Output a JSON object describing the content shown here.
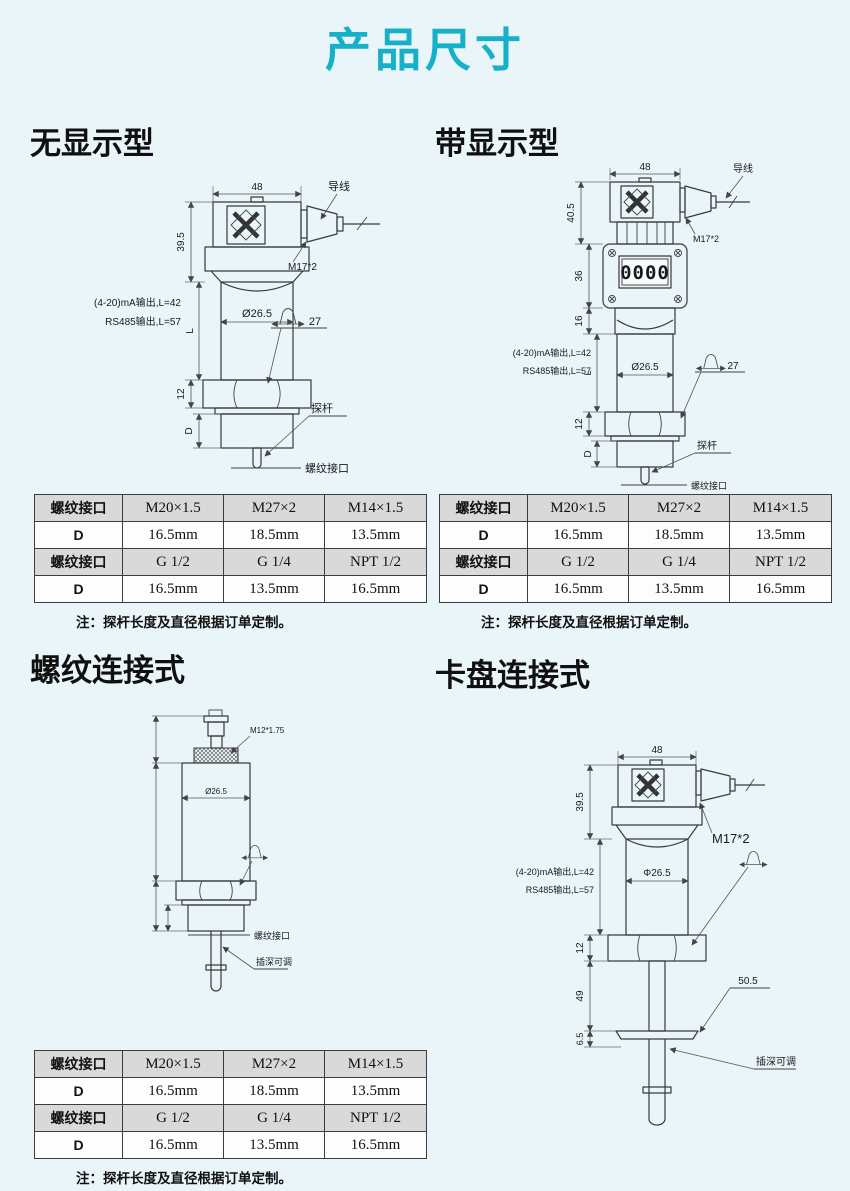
{
  "page": {
    "title": "产品尺寸",
    "accent_color": "#17b0c9",
    "background_color": "#e9f5f8"
  },
  "sections": {
    "no_display": {
      "heading": "无显示型",
      "labels": {
        "width": "48",
        "height": "39.5",
        "wire": "导线",
        "gland": "M17*2",
        "out1": "(4-20)mA输出,L=42",
        "out2": "RS485输出,L=57",
        "dia": "Ø26.5",
        "flats": "27",
        "hex": "12",
        "len": "L",
        "thr": "D",
        "probe": "探杆",
        "iface": "螺纹接口"
      }
    },
    "with_display": {
      "heading": "带显示型",
      "labels": {
        "width": "48",
        "height": "40.5",
        "wire": "导线",
        "gland": "M17*2",
        "disp": "36",
        "neck": "16",
        "lcd": "0000",
        "out1": "(4-20)mA输出,L=42",
        "out2": "RS485输出,L=57",
        "dia": "Ø26.5",
        "flats": "27",
        "hex": "12",
        "len": "L",
        "thr": "D",
        "probe": "探杆",
        "iface": "螺纹接口"
      }
    },
    "threaded": {
      "heading": "螺纹连接式",
      "labels": {
        "tip_thread": "M12*1.75",
        "dia": "Ø26.5",
        "iface": "螺纹接口",
        "depth": "插深可调"
      }
    },
    "chuck": {
      "heading": "卡盘连接式",
      "labels": {
        "width": "48",
        "height": "39.5",
        "gland": "M17*2",
        "out1": "(4-20)mA输出,L=42",
        "out2": "RS485输出,L=57",
        "dia": "Φ26.5",
        "hex": "12",
        "probe_len": "49",
        "flange_t": "6.5",
        "flange_d": "50.5",
        "depth": "插深可调"
      }
    }
  },
  "spec_table": {
    "rows": [
      {
        "label": "螺纹接口",
        "values": [
          "M20×1.5",
          "M27×2",
          "M14×1.5"
        ]
      },
      {
        "label": "D",
        "values": [
          "16.5mm",
          "18.5mm",
          "13.5mm"
        ]
      },
      {
        "label": "螺纹接口",
        "values": [
          "G 1/2",
          "G 1/4",
          "NPT 1/2"
        ]
      },
      {
        "label": "D",
        "values": [
          "16.5mm",
          "13.5mm",
          "16.5mm"
        ]
      }
    ],
    "note": "注：探杆长度及直径根据订单定制。"
  }
}
